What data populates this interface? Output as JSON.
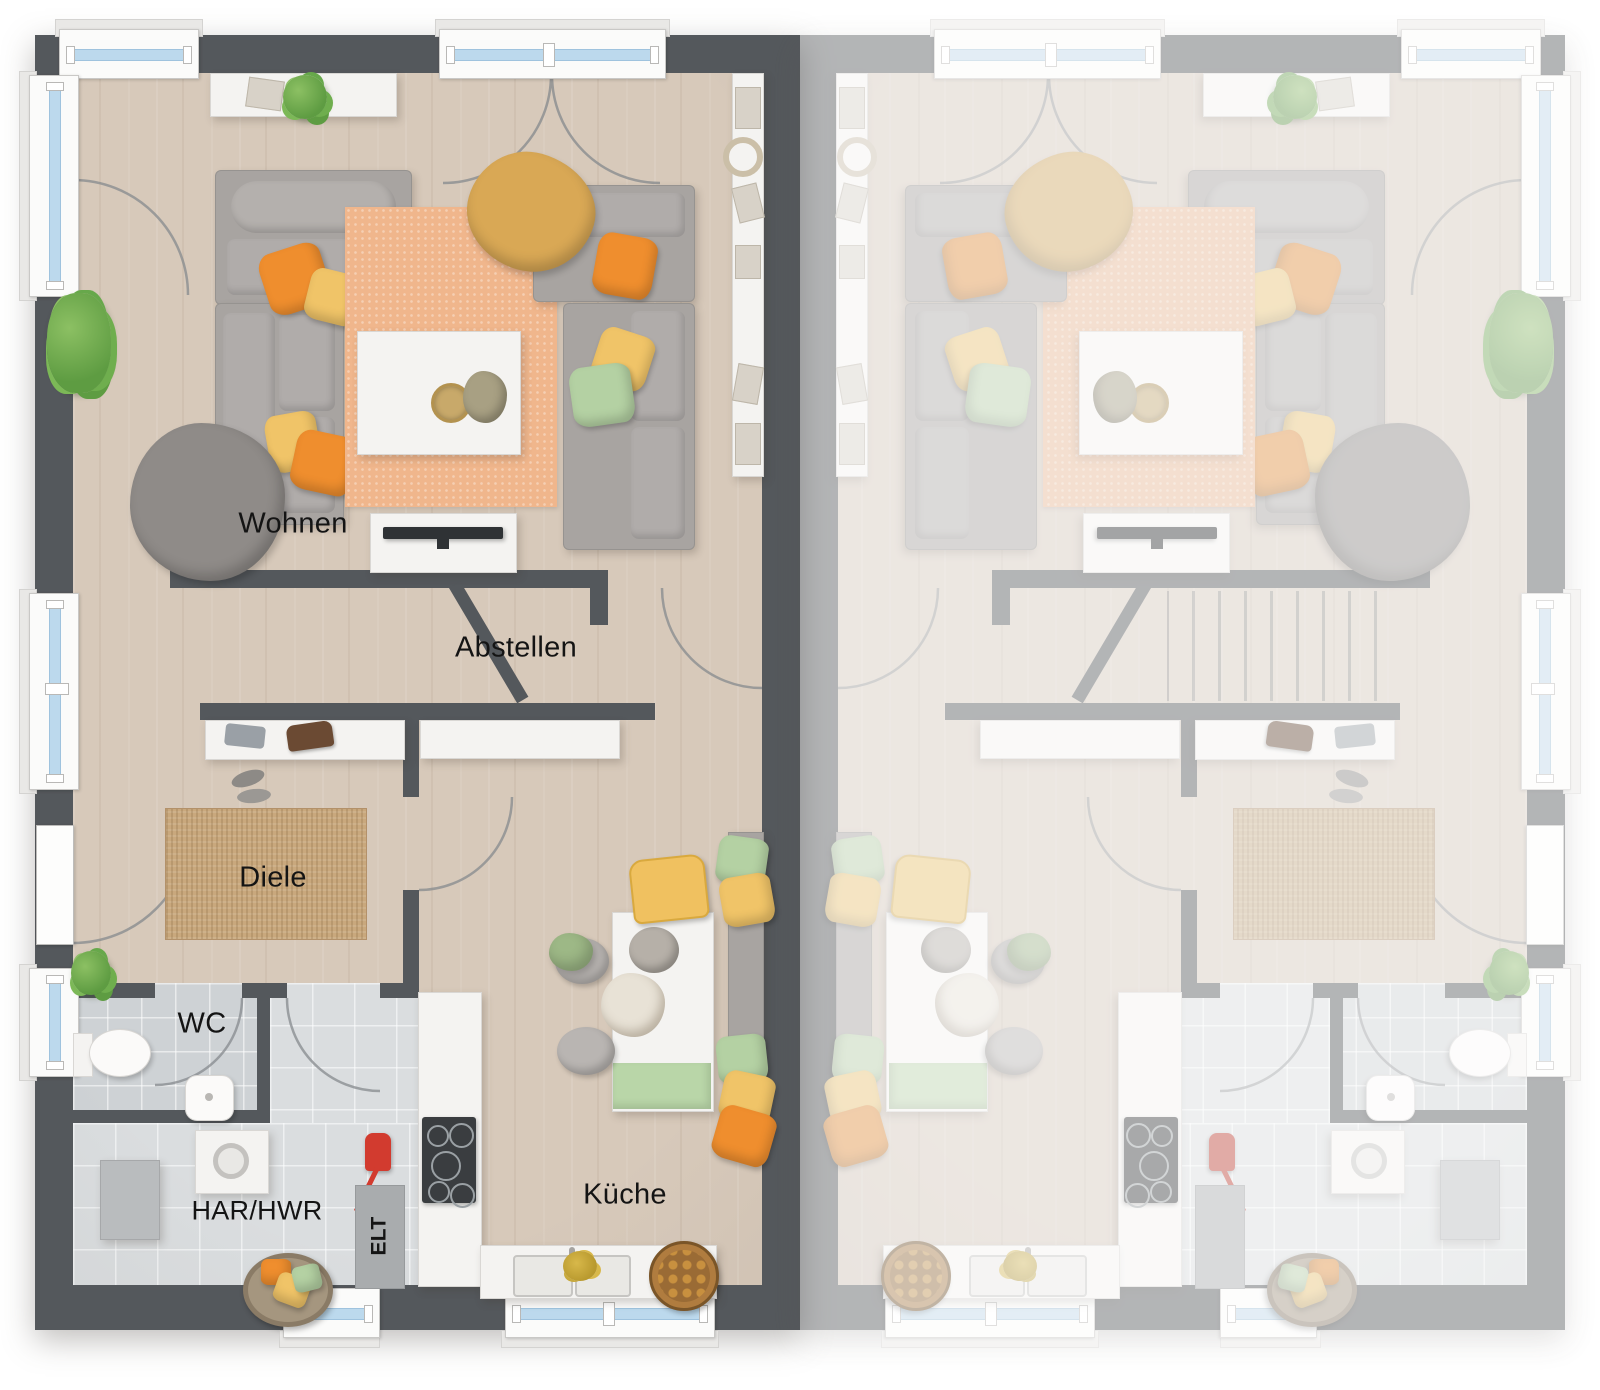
{
  "floorplan": {
    "type": "duplex-ground-floor-plan",
    "units": {
      "left": {
        "rendered": true,
        "labels_visible": true
      },
      "right": {
        "mirrored": true,
        "faded": true,
        "labels_visible": false,
        "shows_staircase": true
      }
    },
    "rooms": {
      "wohnen": "Wohnen",
      "abstellen": "Abstellen",
      "diele": "Diele",
      "wc": "WC",
      "har_hwr": "HAR/HWR",
      "elt": "ELT",
      "kueche": "Küche"
    },
    "colors": {
      "wall": "#54585c",
      "wall_faded": "#a9acaf",
      "floor_wood": "#d7c9ba",
      "floor_tile": "#ced2d5",
      "window_glass": "#bcd9ed",
      "rug_living": "#f0b68c",
      "rug_hall": "#c9a87d",
      "sofa_gray": "#a8a4a1",
      "pillow_orange": "#ef8e2e",
      "pillow_yellow": "#f0c468",
      "pillow_green": "#b4d1a3",
      "blanket_mustard": "#d9a855",
      "accent_red": "#d23b2f",
      "furniture_white": "#f4f3f1"
    }
  }
}
